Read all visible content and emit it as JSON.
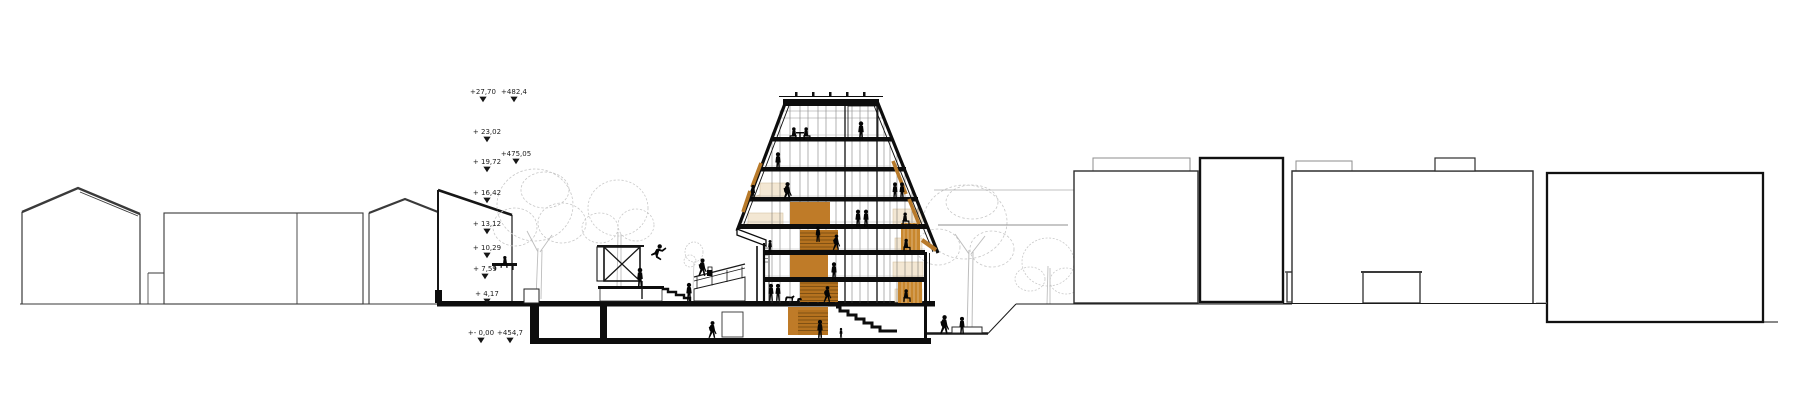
{
  "drawing": {
    "kind": "architectural-longitudinal-section",
    "elevation_markers": {
      "relative": [
        {
          "label": "+27,70",
          "x": 483,
          "y": 94
        },
        {
          "label": "+ 23,02",
          "x": 487,
          "y": 134
        },
        {
          "label": "+ 19,72",
          "x": 487,
          "y": 164
        },
        {
          "label": "+ 16,42",
          "x": 487,
          "y": 195
        },
        {
          "label": "+ 13,12",
          "x": 487,
          "y": 226
        },
        {
          "label": "+ 10,29",
          "x": 487,
          "y": 250
        },
        {
          "label": "+ 7,59",
          "x": 485,
          "y": 271
        },
        {
          "label": "+ 4,17",
          "x": 487,
          "y": 296
        },
        {
          "label": "+- 0,00",
          "x": 481,
          "y": 335
        }
      ],
      "absolute": [
        {
          "label": "+482,4",
          "x": 514,
          "y": 94
        },
        {
          "label": "+475,05",
          "x": 516,
          "y": 156
        },
        {
          "label": "+454,7",
          "x": 510,
          "y": 335
        }
      ]
    },
    "colors": {
      "line_black": "#141414",
      "context_line": "#3a3a3a",
      "tree_gray": "#c7c7c7",
      "accent_orange": "#bf7b28",
      "stair_orange": "#b5721f",
      "slat_tan": "#c8872e",
      "room_beige": "#f3e7d3"
    },
    "scene": {
      "people_count": 30,
      "trees_count": 5,
      "context_buildings_left": 4,
      "context_buildings_right": 4
    }
  }
}
